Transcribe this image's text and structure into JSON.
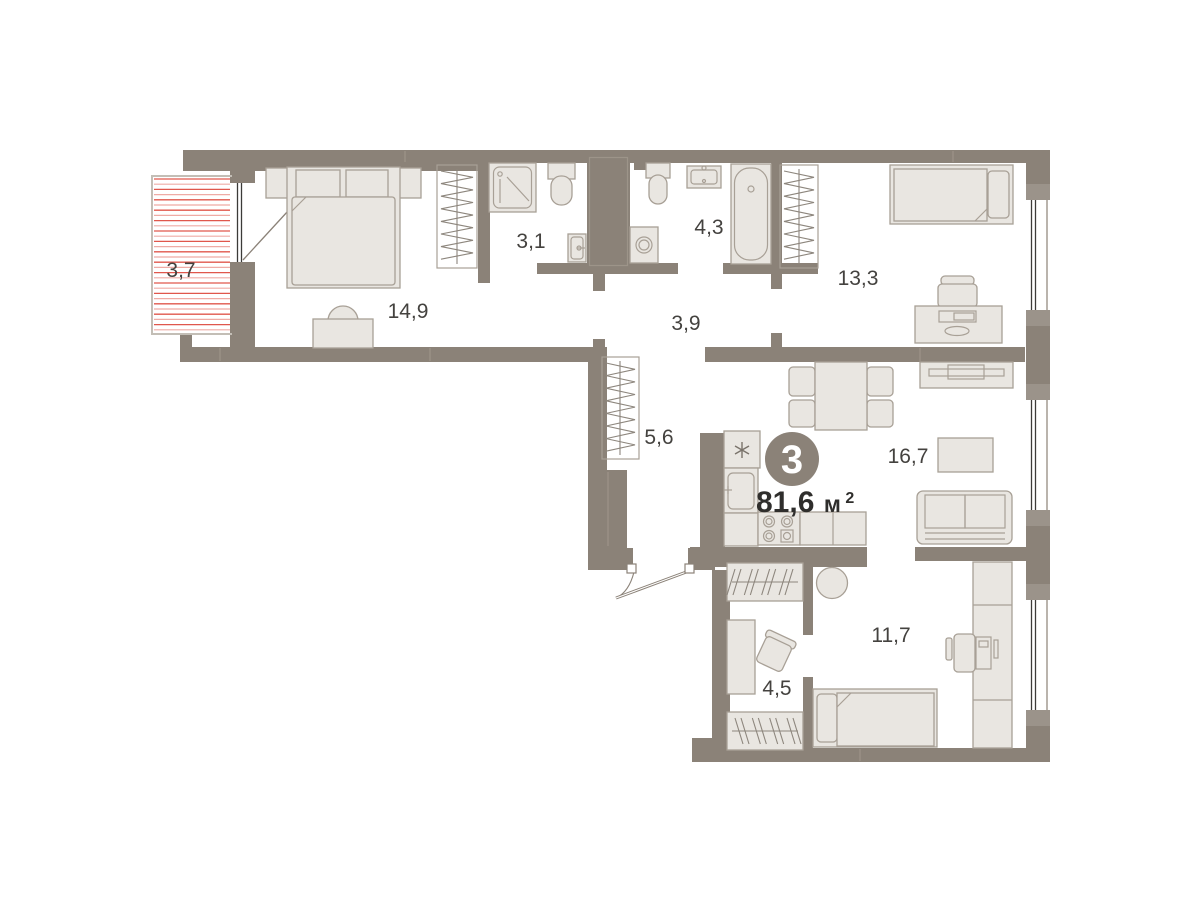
{
  "plan": {
    "type": "apartment-floor-plan",
    "badge": {
      "rooms_count": "3"
    },
    "total_area": {
      "value": "81,6",
      "unit": "м",
      "unit_exponent": "2"
    },
    "room_labels": [
      {
        "name": "balcony",
        "area": "3,7"
      },
      {
        "name": "bedroom",
        "area": "14,9"
      },
      {
        "name": "shower-room",
        "area": "3,1"
      },
      {
        "name": "bathroom",
        "area": "4,3"
      },
      {
        "name": "bedroom-2",
        "area": "13,3"
      },
      {
        "name": "hallway",
        "area": "3,9"
      },
      {
        "name": "corridor",
        "area": "5,6"
      },
      {
        "name": "kitchen-living-room",
        "area": "16,7"
      },
      {
        "name": "bedroom-3",
        "area": "11,7"
      },
      {
        "name": "wardrobe-room",
        "area": "4,5"
      }
    ],
    "colors": {
      "walls": "#8b8278",
      "furniture_fill": "#e9e6e1",
      "furniture_stroke": "#a8a096",
      "balcony_hatch": "#e0574c",
      "label_text": "#44423f",
      "badge_fill": "#8b8278",
      "badge_text": "#ffffff"
    }
  }
}
